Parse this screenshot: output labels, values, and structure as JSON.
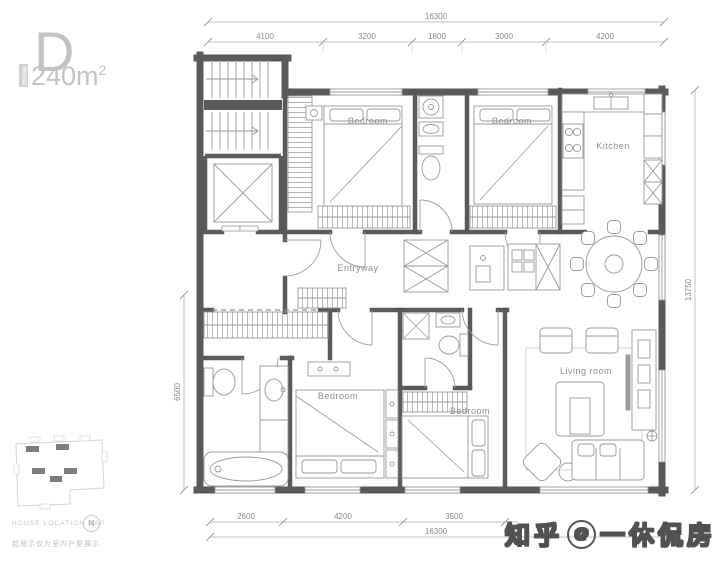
{
  "header": {
    "plan_letter": "D",
    "area_badge": "建筑面积",
    "area_value": "240m",
    "area_exponent": "2"
  },
  "dimensions": {
    "top_overall": "16300",
    "top_segments": [
      "4100",
      "3200",
      "1800",
      "3000",
      "4200"
    ],
    "bottom_segments": [
      "2600",
      "4200",
      "3500"
    ],
    "bottom_overall": "16300",
    "left": "6500",
    "right": "13750"
  },
  "rooms": {
    "bedroom_top_left": "Bedroom",
    "bedroom_top_right": "Bedroom",
    "kitchen": "Kitchen",
    "entryway": "Entryway",
    "bedroom_bottom_left": "Bedroom",
    "bedroom_bottom_middle": "Bedroom",
    "living_room": "Living room"
  },
  "footer": {
    "map_title": "HOUSE LOCATION MAP",
    "compass_letter": "N",
    "disclaimer": "起居示仅为室内户型展示"
  },
  "watermark": {
    "brand": "知乎",
    "at_symbol": "@",
    "handle": "一休侃房"
  },
  "colors": {
    "wall": "#5a5a5a",
    "furniture_line": "#9a9a9a",
    "dimension_text": "#8a8a8a",
    "room_label_text": "#8f8f8f",
    "header_text": "#c3c3c3",
    "watermark_outline": "#515151"
  }
}
